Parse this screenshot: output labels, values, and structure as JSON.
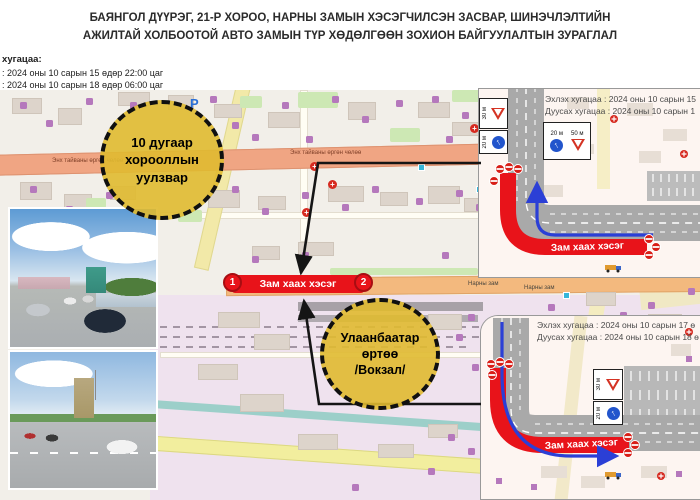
{
  "title": {
    "line1": "БАЯНГОЛ ДҮҮРЭГ, 21-Р ХОРОО, НАРНЫ ЗАМЫН ХЭСЭГЧИЛСЭН ЗАСВАР, ШИНЭЧЛЭЛТИЙН",
    "line2": "АЖИЛТАЙ ХОЛБООТОЙ АВТО ЗАМЫН ТҮР ХӨДӨЛГӨӨН ЗОХИОН БАЙГУУЛАЛТЫН ЗУРАГЛАЛ"
  },
  "schedule": {
    "label": "хугацаа:",
    "start": ": 2024 оны 10 сарын 15 өдөр 22:00 цаг",
    "end": ": 2024 оны 10 сарын 18 өдөр 06:00 цаг"
  },
  "callouts": {
    "junction": {
      "line1": "10 дугаар",
      "line2": "хорооллын",
      "line3": "уулзвар"
    },
    "station": {
      "line1": "Улаанбаатар",
      "line2": "өртөө",
      "line3": "/Вокзал/"
    }
  },
  "closure": {
    "label": "Зам хаах хэсэг",
    "marker1": "1",
    "marker2": "2"
  },
  "map_labels": {
    "peace_avenue": "Энх тайваны өргөн чөлөө",
    "narny_zam": "Нарны зам",
    "parking": "P"
  },
  "insets": {
    "north": {
      "start": "Эхлэх хугацаа : 2024 оны 10 сарын 15",
      "end": "Дуусах хугацаа : 2024 оны 10 сарын 1",
      "closure_label": "Зам хаах хэсэг",
      "dist_30": "30 м",
      "dist_20": "20 м",
      "dist_20b": "20 м",
      "dist_50": "50 м"
    },
    "south": {
      "start": "Эхлэх хугацаа : 2024 оны 10 сарын 17 ө",
      "end": "Дуусах хугацаа : 2024 оны 10 сарын 18 ө",
      "closure_label": "Зам хаах хэсэг",
      "dist_30": "30 м",
      "dist_20": "20 м"
    }
  },
  "colors": {
    "closure_red": "#e8131a",
    "callout_yellow": "#e0ba30",
    "detour_blue": "#2b3fd6",
    "peace_road_orange": "#f0a583",
    "narny_road_orange": "#f3b97e",
    "map_bg": "#f2efe9",
    "station_lavender": "#efe2ee",
    "river_teal": "#9ccfc9",
    "minor_road_yellow": "#f2ee9e"
  },
  "map": {
    "buildings": [
      [
        12,
        8,
        28,
        14
      ],
      [
        58,
        18,
        22,
        15
      ],
      [
        118,
        2,
        30,
        12
      ],
      [
        168,
        5,
        24,
        13
      ],
      [
        214,
        14,
        26,
        12
      ],
      [
        268,
        22,
        30,
        14
      ],
      [
        348,
        12,
        26,
        16
      ],
      [
        418,
        12,
        30,
        14
      ],
      [
        452,
        32,
        28,
        12
      ],
      [
        20,
        92,
        30,
        16
      ],
      [
        64,
        104,
        26,
        14
      ],
      [
        110,
        96,
        24,
        12
      ],
      [
        208,
        100,
        30,
        16
      ],
      [
        258,
        106,
        26,
        12
      ],
      [
        328,
        96,
        34,
        14
      ],
      [
        380,
        102,
        26,
        12
      ],
      [
        428,
        96,
        30,
        16
      ],
      [
        464,
        108,
        22,
        12
      ],
      [
        298,
        152,
        34,
        12
      ],
      [
        252,
        156,
        26,
        12
      ],
      [
        218,
        222,
        40,
        14
      ],
      [
        254,
        244,
        34,
        14
      ],
      [
        428,
        224,
        32,
        14
      ],
      [
        198,
        274,
        38,
        14
      ],
      [
        240,
        304,
        42,
        16
      ],
      [
        298,
        344,
        38,
        14
      ],
      [
        378,
        354,
        34,
        12
      ],
      [
        428,
        334,
        28,
        12
      ],
      [
        586,
        202,
        28,
        12
      ],
      [
        648,
        224,
        32,
        12
      ]
    ],
    "greens": [
      [
        298,
        2,
        40,
        16
      ],
      [
        240,
        6,
        22,
        12
      ],
      [
        390,
        38,
        30,
        14
      ],
      [
        452,
        0,
        38,
        12
      ],
      [
        330,
        178,
        148,
        7
      ],
      [
        178,
        120,
        24,
        12
      ],
      [
        86,
        108,
        20,
        10
      ]
    ],
    "pois": [
      [
        20,
        12
      ],
      [
        46,
        30
      ],
      [
        86,
        8
      ],
      [
        130,
        12
      ],
      [
        210,
        6
      ],
      [
        232,
        32
      ],
      [
        282,
        12
      ],
      [
        332,
        6
      ],
      [
        362,
        26
      ],
      [
        396,
        10
      ],
      [
        432,
        6
      ],
      [
        462,
        22
      ],
      [
        252,
        44
      ],
      [
        306,
        46
      ],
      [
        446,
        46
      ],
      [
        30,
        96
      ],
      [
        66,
        116
      ],
      [
        106,
        102
      ],
      [
        232,
        96
      ],
      [
        262,
        118
      ],
      [
        302,
        102
      ],
      [
        342,
        114
      ],
      [
        372,
        96
      ],
      [
        416,
        108
      ],
      [
        456,
        100
      ],
      [
        476,
        114
      ],
      [
        252,
        166
      ],
      [
        302,
        162
      ],
      [
        442,
        162
      ],
      [
        468,
        224
      ],
      [
        456,
        244
      ],
      [
        472,
        274
      ],
      [
        448,
        344
      ],
      [
        468,
        358
      ],
      [
        428,
        378
      ],
      [
        352,
        394
      ],
      [
        548,
        214
      ],
      [
        648,
        212
      ],
      [
        688,
        198
      ],
      [
        620,
        222
      ]
    ],
    "crosses": [
      [
        310,
        72
      ],
      [
        328,
        90
      ],
      [
        302,
        118
      ],
      [
        470,
        34
      ]
    ],
    "stops": [
      [
        152,
        84
      ],
      [
        418,
        74
      ],
      [
        563,
        202
      ],
      [
        232,
        190
      ],
      [
        476,
        96
      ]
    ]
  }
}
